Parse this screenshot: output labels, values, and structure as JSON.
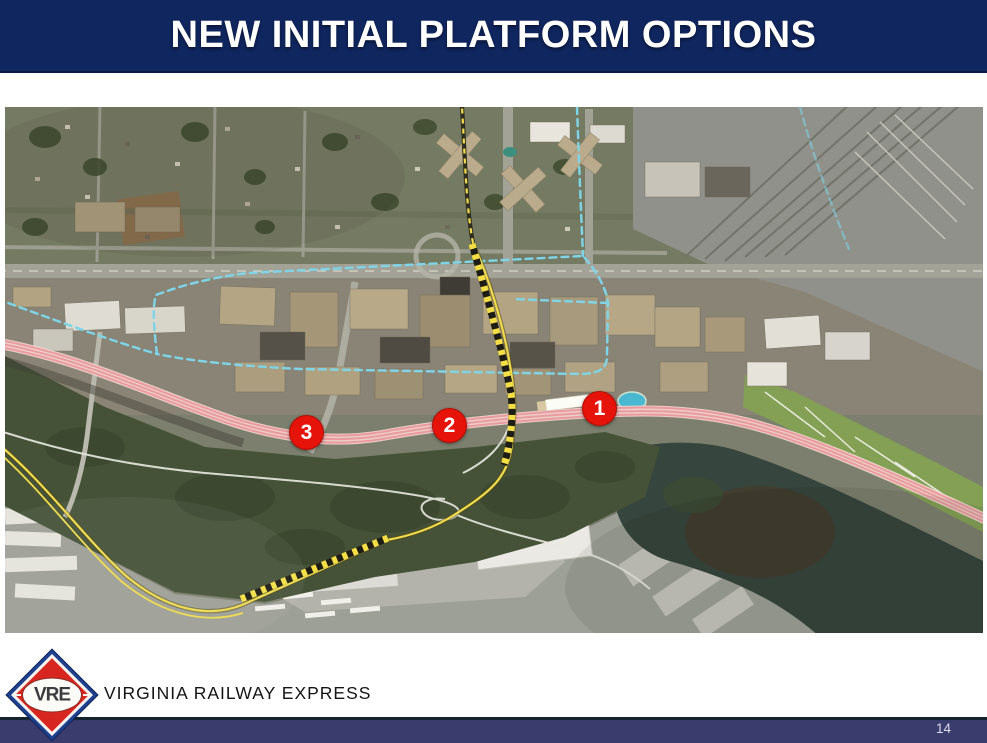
{
  "slide": {
    "title": "NEW INITIAL PLATFORM OPTIONS",
    "page_number": "14"
  },
  "branding": {
    "logo_text": "VRE",
    "organization": "VIRGINIA RAILWAY EXPRESS"
  },
  "map": {
    "type": "satellite-aerial",
    "description": "Aerial imagery of the Crystal City rail corridor showing three numbered platform option locations with rail, proposed-route and study-area overlays",
    "markers": [
      {
        "label": "1",
        "x": 594,
        "y": 301
      },
      {
        "label": "2",
        "x": 444,
        "y": 318
      },
      {
        "label": "3",
        "x": 301,
        "y": 325
      }
    ],
    "overlay_colors": {
      "existing_rail_pink": "#ec9aa0",
      "proposed_route_yellow": "#efdb4c",
      "study_area_blue": "#7fd5e8",
      "marker_red": "#e6130a",
      "platform_white": "#fcfcf7"
    }
  },
  "theme": {
    "header_background": "#10265f",
    "footer_bar_background": "#3b3c6e",
    "logo_red": "#d7261f",
    "logo_blue": "#1e418f"
  }
}
